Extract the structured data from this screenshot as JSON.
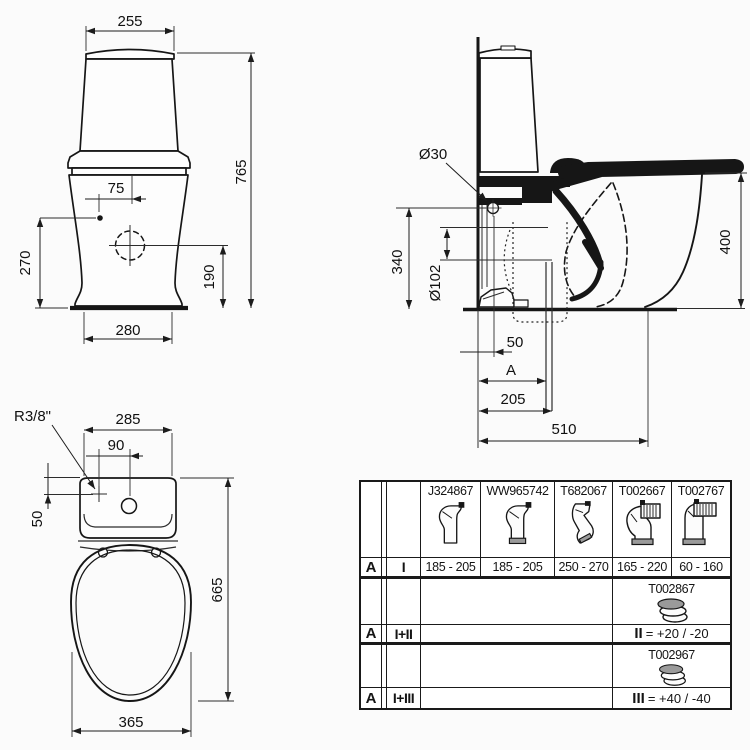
{
  "drawing": {
    "front": {
      "dim_width_top": "255",
      "dim_height": "765",
      "dim_hole_offset": "75",
      "dim_left_height": "270",
      "dim_right_height": "190",
      "dim_base_width": "280"
    },
    "side": {
      "dim_hole_dia": "Ø30",
      "dim_back_height": "340",
      "dim_outlet_dia": "Ø102",
      "dim_rim_height": "400",
      "dim_wall_gap": "50",
      "dim_var": "A",
      "dim_outlet_depth": "205",
      "dim_total_depth": "510"
    },
    "top": {
      "dim_inlet_thread": "R3/8\"",
      "dim_tank_width": "285",
      "dim_hole_spacing": "90",
      "dim_inlet_depth": "50",
      "dim_total_length": "665",
      "dim_seat_width": "365"
    }
  },
  "table": {
    "columns": [
      {
        "part": "J324867",
        "range": "185 - 205",
        "icon": "s-bend-connector-icon"
      },
      {
        "part": "WW965742",
        "range": "185 - 205",
        "icon": "s-bend-connector-sleeve-icon"
      },
      {
        "part": "T682067",
        "range": "250 - 270",
        "icon": "angled-connector-icon"
      },
      {
        "part": "T002667",
        "range": "165 - 220",
        "icon": "flexible-elbow-connector-icon"
      },
      {
        "part": "T002767",
        "range": "60 - 160",
        "icon": "elbow-connector-icon"
      }
    ],
    "rows": [
      {
        "zone": "A",
        "config": "I"
      },
      {
        "zone": "A",
        "config": "I+II",
        "accessory_part": "T002867",
        "accessory_icon": "offset-coupler-icon",
        "formula_roman": "II",
        "formula_value": "= +20 / -20"
      },
      {
        "zone": "A",
        "config": "I+III",
        "accessory_part": "T002967",
        "accessory_icon": "offset-coupler-icon",
        "formula_roman": "III",
        "formula_value": "= +40 / -40"
      }
    ]
  }
}
